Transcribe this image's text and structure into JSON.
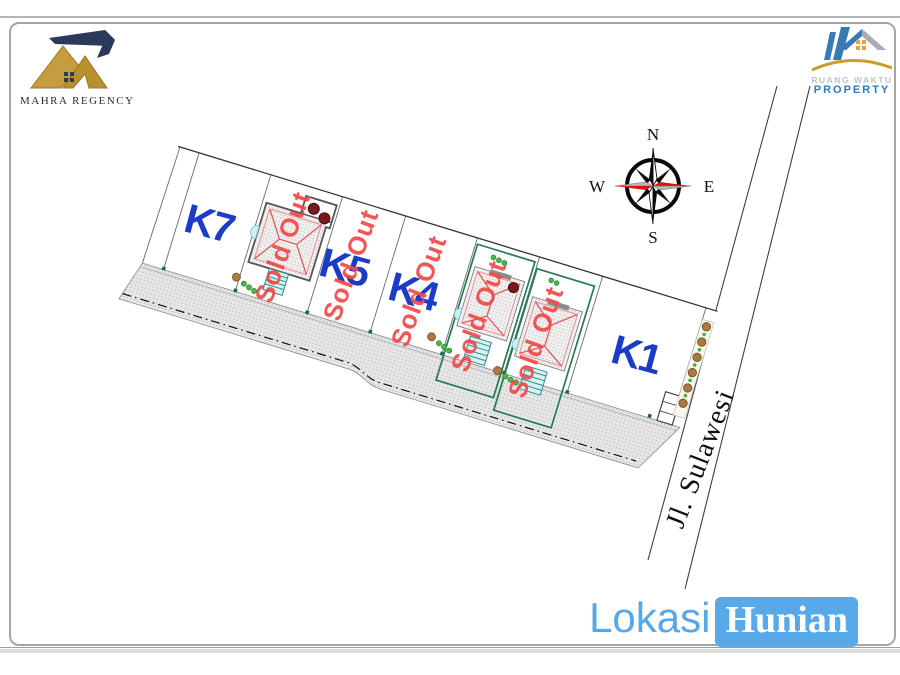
{
  "header": {
    "mahra_logo": {
      "name": "MAHRA REGENCY"
    },
    "ruang_waktu_logo": {
      "line1": "RUANG WAKTU",
      "line2": "PROPERTY"
    }
  },
  "compass": {
    "north": "N",
    "east": "E",
    "south": "S",
    "west": "W"
  },
  "site_plan": {
    "sold_out_label": "Sold Out",
    "street_label": "Jl. Sulawesi",
    "plots": [
      {
        "label": "K7",
        "sold": false
      },
      {
        "label": "",
        "sold": true
      },
      {
        "label": "K5",
        "sold": true
      },
      {
        "label": "K4",
        "sold": true
      },
      {
        "label": "",
        "sold": true
      },
      {
        "label": "",
        "sold": true
      },
      {
        "label": "K1",
        "sold": false
      }
    ]
  },
  "footer": {
    "lokasi": "Lokasi",
    "hunian": "Hunian"
  },
  "colors": {
    "plot_label_blue": "#1b3cc8",
    "sold_out_red": "#f34949",
    "footer_blue": "#58a9e9",
    "compass_red": "#e01010",
    "compass_silver": "#b9b9b9",
    "logo_gold": "#c59d3e",
    "logo_navy": "#2b3a5c",
    "house_frame_green": "#257a56",
    "stairs_teal": "#2f8f8f"
  }
}
